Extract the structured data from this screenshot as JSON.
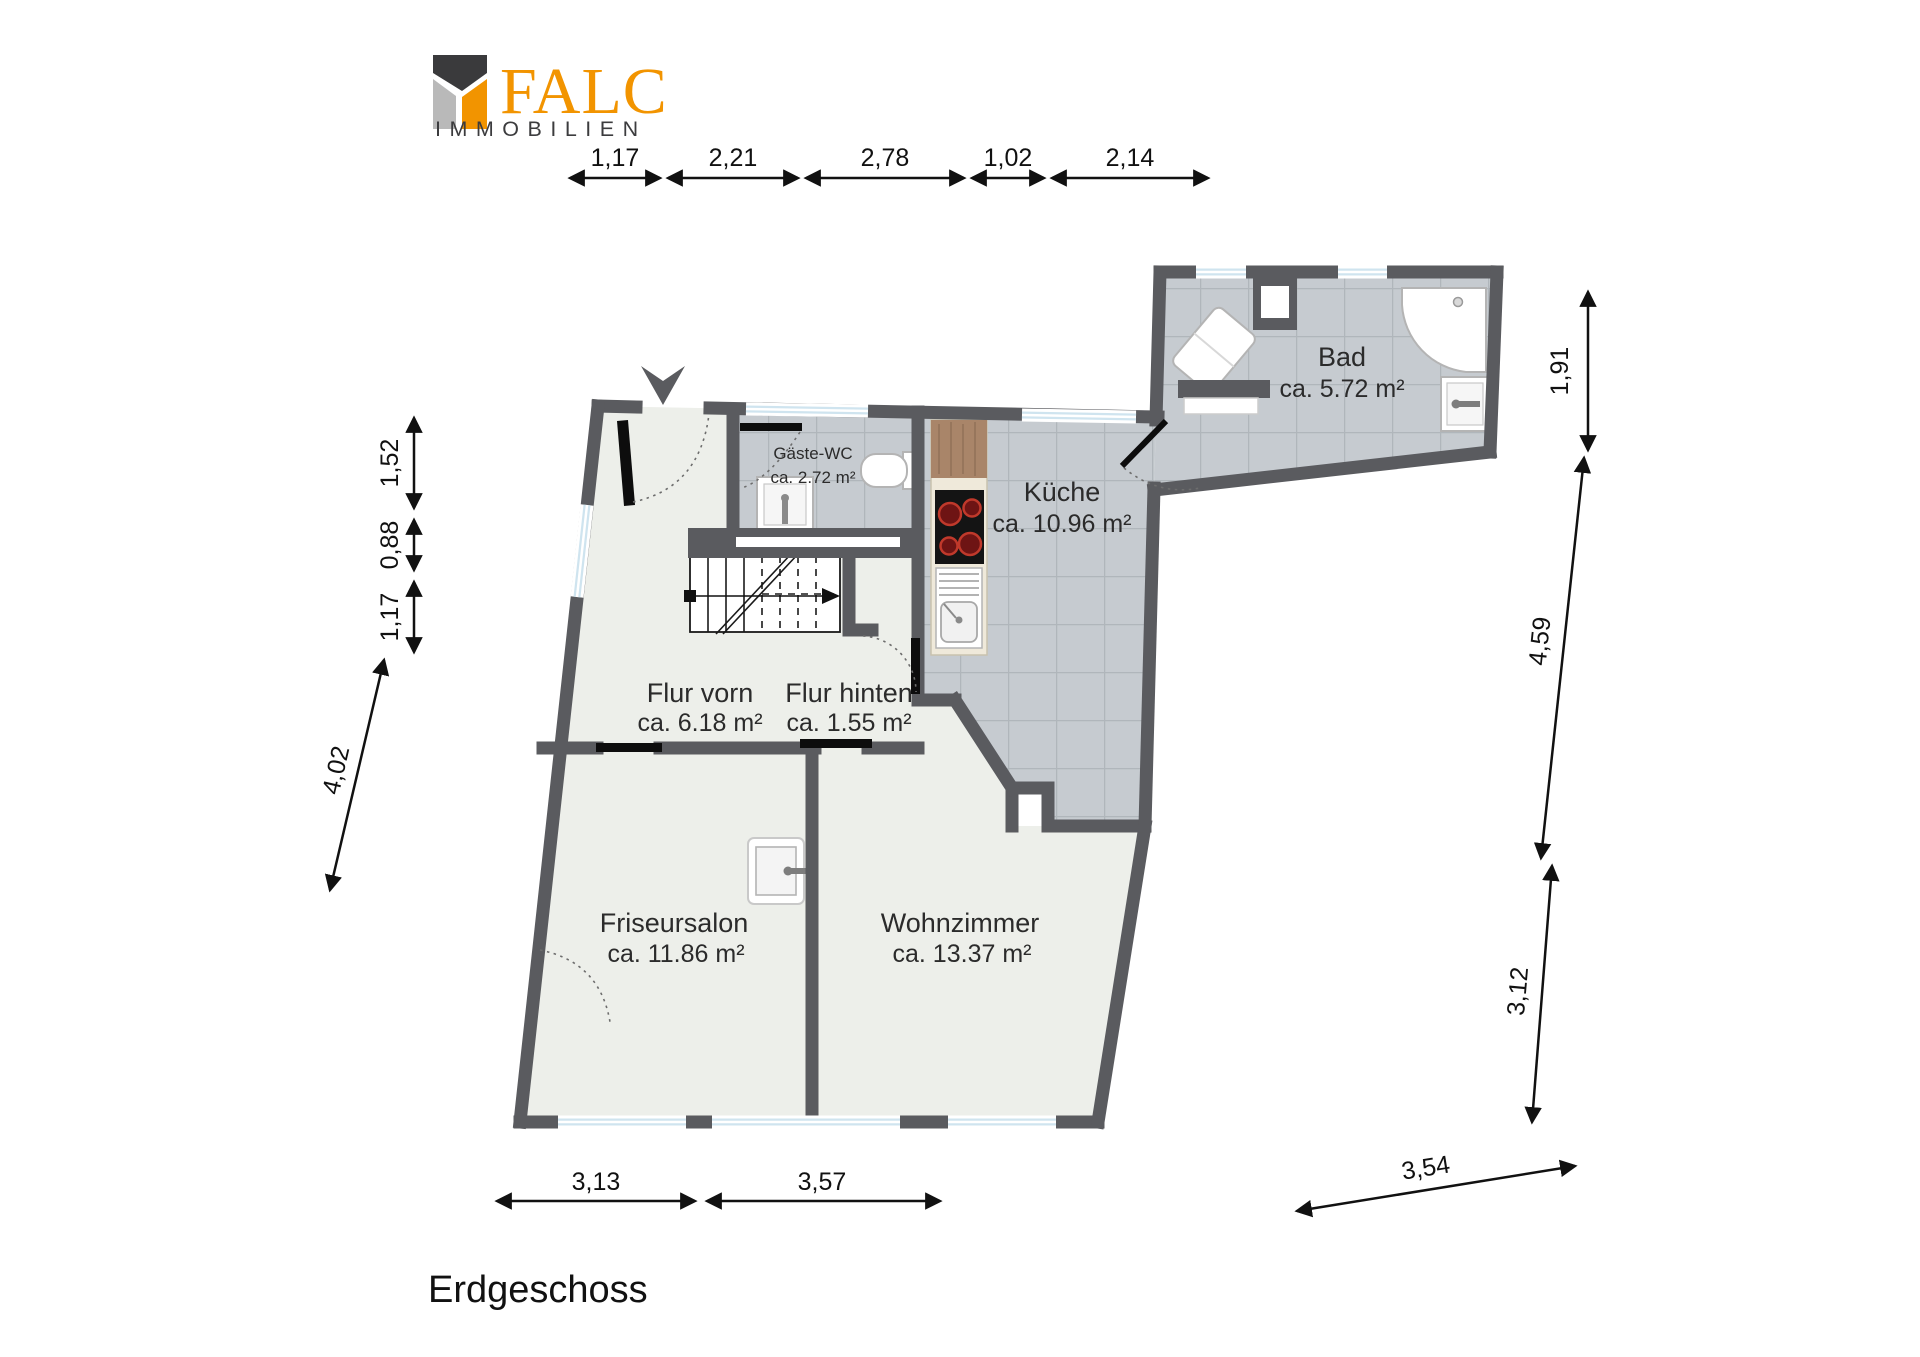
{
  "logo": {
    "brand": "FALC",
    "subtitle": "IMMOBILIEN",
    "colors": {
      "orange": "#F29400",
      "dark": "#3A3A3C",
      "light": "#B9B9B9"
    }
  },
  "floor_title": "Erdgeschoss",
  "rooms": [
    {
      "id": "bad",
      "name": "Bad",
      "area": "ca. 5.72 m²"
    },
    {
      "id": "kueche",
      "name": "Küche",
      "area": "ca. 10.96 m²"
    },
    {
      "id": "gaeste_wc",
      "name": "Gäste-WC",
      "area": "ca. 2.72 m²"
    },
    {
      "id": "flur_vorn",
      "name": "Flur vorn",
      "area": "ca. 6.18 m²"
    },
    {
      "id": "flur_hinten",
      "name": "Flur hinten",
      "area": "ca. 1.55 m²"
    },
    {
      "id": "friseursalon",
      "name": "Friseursalon",
      "area": "ca. 11.86 m²"
    },
    {
      "id": "wohnzimmer",
      "name": "Wohnzimmer",
      "area": "ca. 13.37 m²"
    }
  ],
  "dimensions": {
    "top": [
      "1,17",
      "2,21",
      "2,78",
      "1,02",
      "2,14"
    ],
    "left": [
      "1,52",
      "0,88",
      "1,17",
      "4,02"
    ],
    "right": [
      "1,91",
      "4,59",
      "3,12",
      "3,54"
    ],
    "bottom": [
      "3,13",
      "3,57"
    ]
  },
  "colors": {
    "wall": "#5A5B5F",
    "tile_floor": "#C6CBD0",
    "light_floor": "#EDEFEA",
    "window_glass": "#CFE4EF",
    "dimension_ink": "#111111",
    "stove_burner": "#B22222",
    "counter_wood": "#A98569"
  }
}
